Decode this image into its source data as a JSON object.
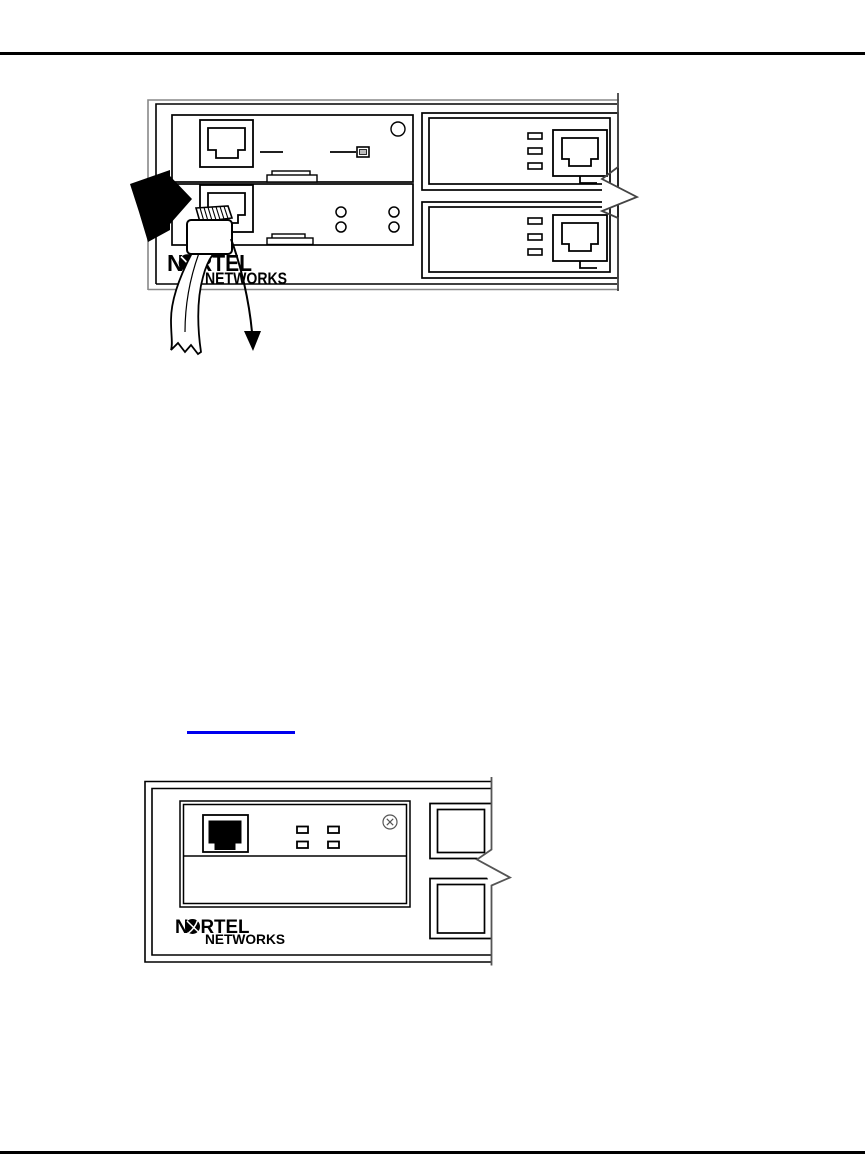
{
  "page": {
    "background": "#ffffff",
    "rule_color": "#000000"
  },
  "link": {
    "color": "#0000ee"
  },
  "logo": {
    "n": "N",
    "rtel": "RTEL",
    "networks": "NETWORKS",
    "globe_color": "#000000"
  }
}
